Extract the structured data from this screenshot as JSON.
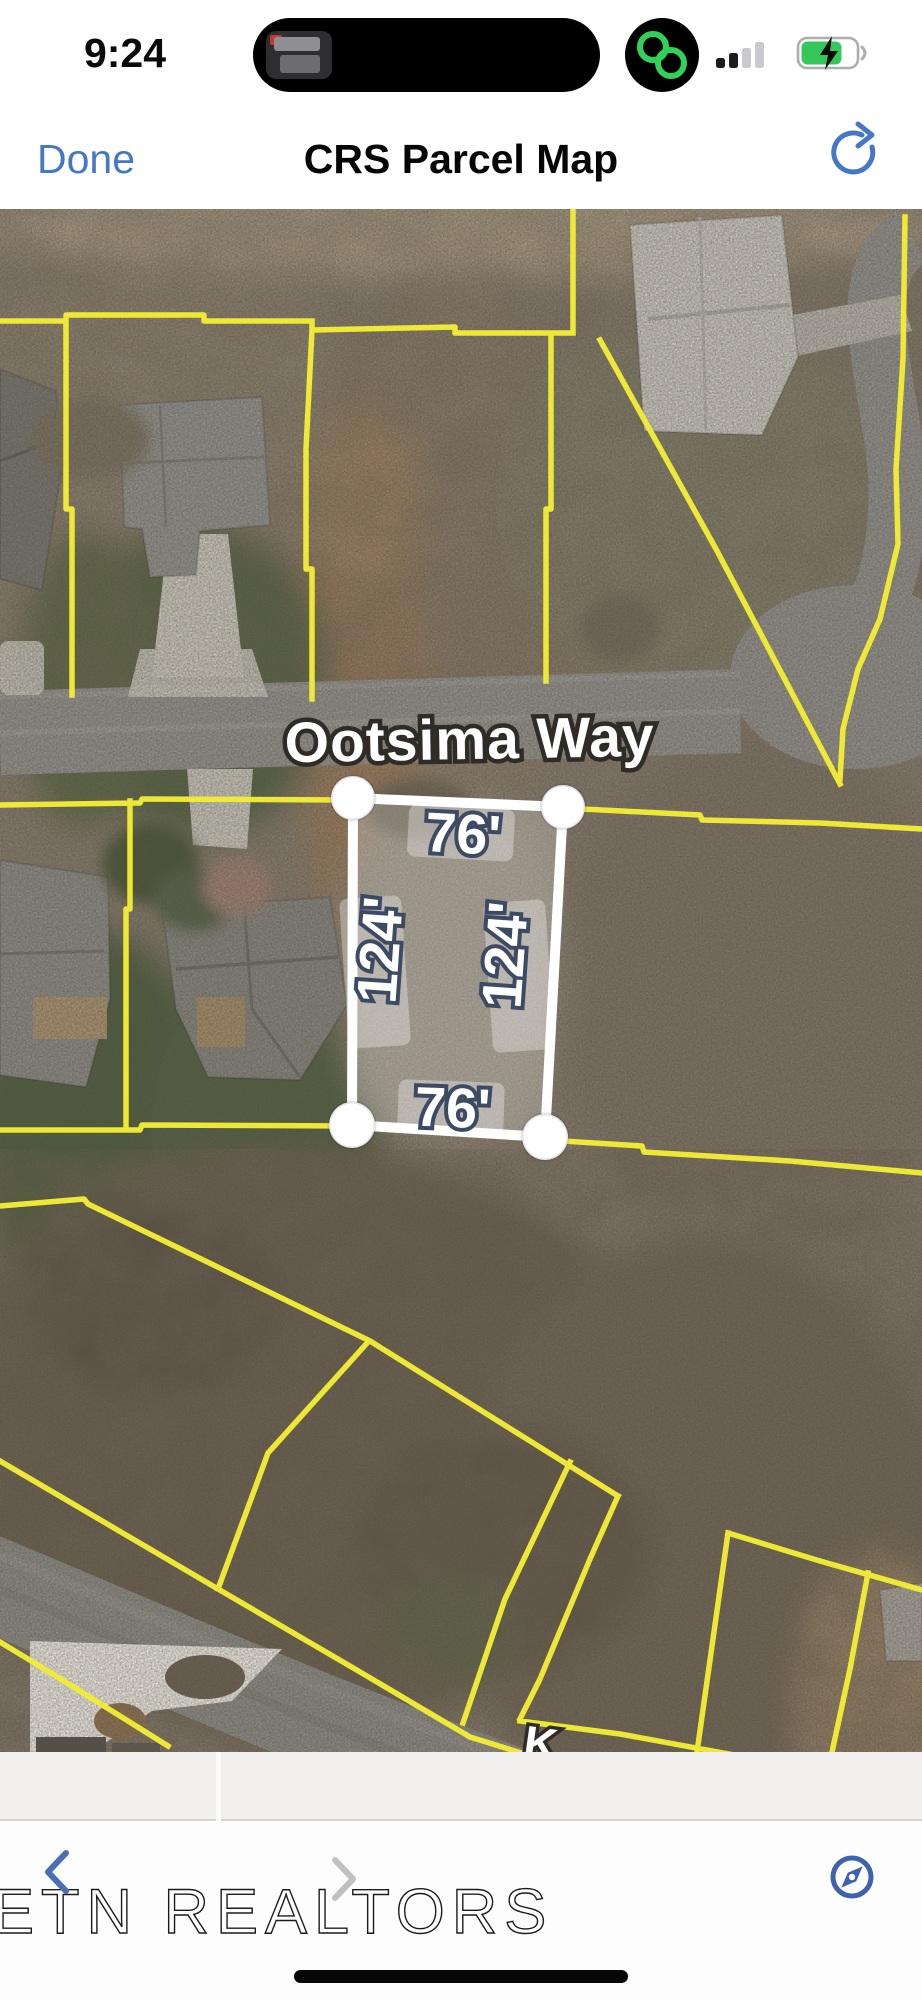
{
  "status_bar": {
    "time": "9:24"
  },
  "nav": {
    "done_label": "Done",
    "title": "CRS Parcel Map"
  },
  "map": {
    "street_label": "Ootsima Way",
    "street_label_partial": "K",
    "selected_parcel": {
      "front": "76'",
      "rear": "76'",
      "side_left": "124'",
      "side_right": "124'"
    }
  },
  "footer": {
    "watermark": "ETN REALTORS"
  },
  "colors": {
    "parcel_line_yellow": "#f2ec35",
    "selection_white": "#ffffff",
    "dimension_outline": "#3d4a63",
    "accent_blue": "#4577c8",
    "compass_blue": "#3f62ae",
    "island_ring_green": "#30d158",
    "battery_green": "#35c759"
  }
}
